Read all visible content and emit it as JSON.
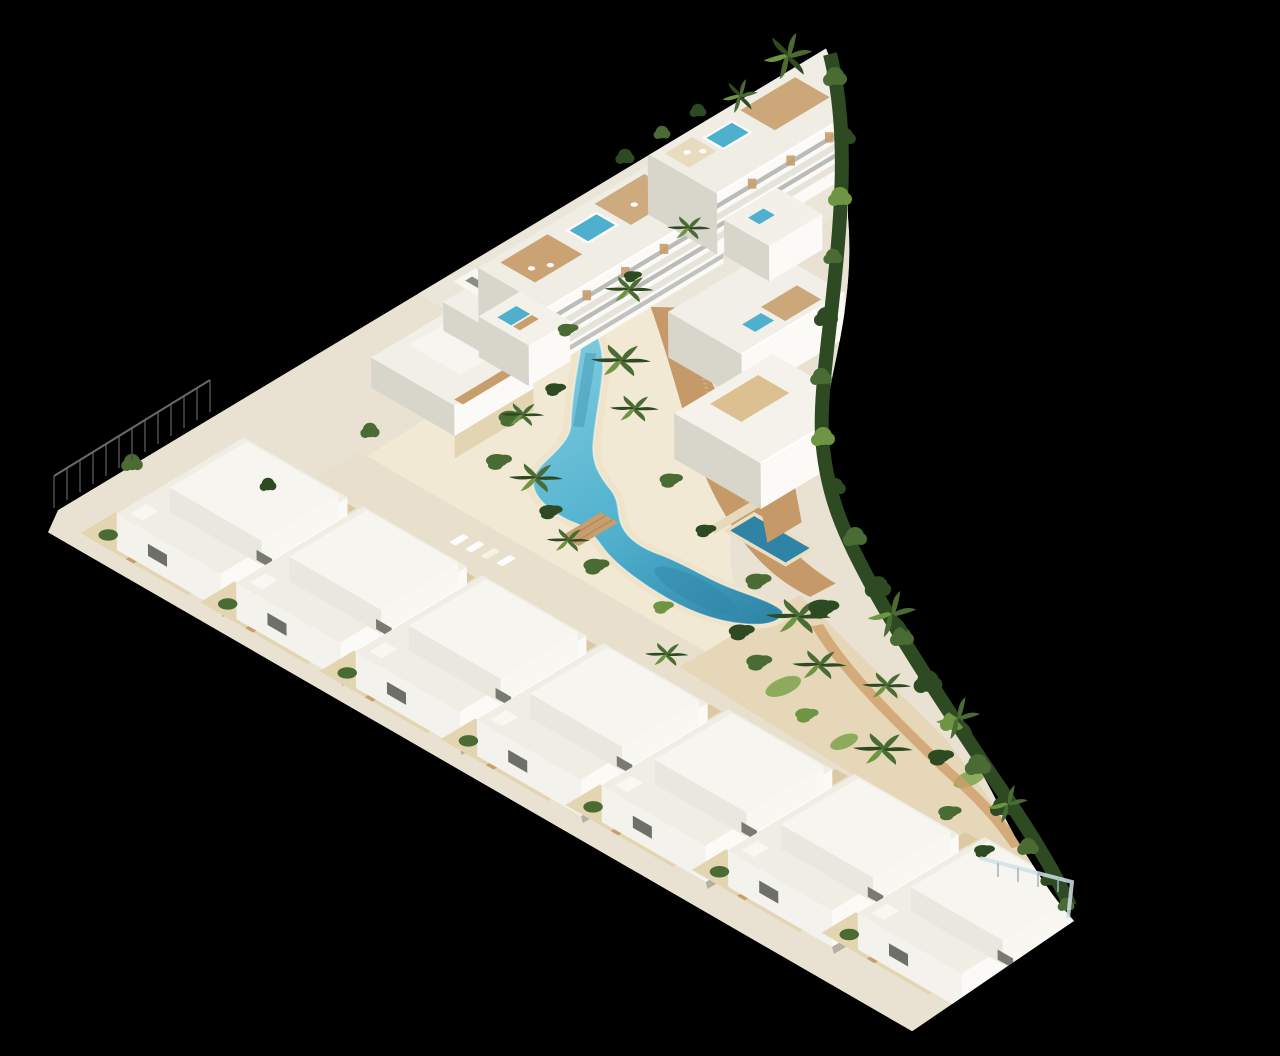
{
  "image": {
    "kind": "3D architectural aerial render",
    "alt": "Aerial 3D rendering of a triangular white Mediterranean-style residential complex on a black background, with a winding turquoise lagoon pool, sandy beach, palm trees, timber boardwalk, a row of white villas along the lower edge, apartment blocks with roof terraces at the top, and a lap pool beside the eastern buildings.",
    "description": "Isometric-style architect's visualization of a resort development: white Ibiza-style villas and three-storey apartment buildings with wooden pergolas and rooftop plunge pools arranged around a free-form lagoon swimming pool with beach areas, palms, gardens, a footbridge and curved perimeter hedge; the plot is triangular and floats on a pure black background.",
    "background_color": "#000000"
  },
  "scene": {
    "site_shape": "triangular plot with curved right boundary",
    "counts": {
      "bottom_row_villas": 7,
      "upper_left_villas": 2,
      "apartment_storeys": 3,
      "rooftop_plunge_pools": 5,
      "beach_loungers": 4
    },
    "features": {
      "lagoon_pool": "free-form winding lagoon-style swimming pool",
      "lap_pool": "rectangular dark-blue lap pool beside the east building",
      "rooftop_pools": "small turquoise plunge pools and jacuzzis on roof terraces",
      "boardwalk": "curved timber boardwalk along the lagoon",
      "beach": "sand beach area with sun loungers",
      "bridge": "timber footbridge crossing the lagoon",
      "vegetation": "palm trees, shrubs and a perimeter hedge",
      "left_fence": "thin metal picket fence at the west corner",
      "glass_fence": "glass balustrade at the south-east corner"
    },
    "colors": {
      "background": "#000000",
      "roof": "#efede4",
      "roof_alt": "#f1efe7",
      "wall_bright": "#fbfaf6",
      "wall_front": "#f3f2ec",
      "wall_shade": "#d8d5cb",
      "ground": "#e9e2d2",
      "plaza": "#eae6da",
      "sand": "#f2e9d4",
      "garden_sand": "#e5d7b8",
      "deck": "#e3d4b2",
      "gap_deck": "#dcc9a4",
      "wood": "#c89e6d",
      "path": "#c69a68",
      "pool_light": "#7ccadd",
      "pool": "#4fb0cd",
      "pool_deep": "#2f84a6",
      "veg_dark": "#2e4a22",
      "veg_mid": "#4a6b33",
      "veg_light": "#6f9444",
      "grass": "#7fa34c",
      "glass": "#cfe0e6",
      "fence": "#4a4a4a"
    }
  }
}
